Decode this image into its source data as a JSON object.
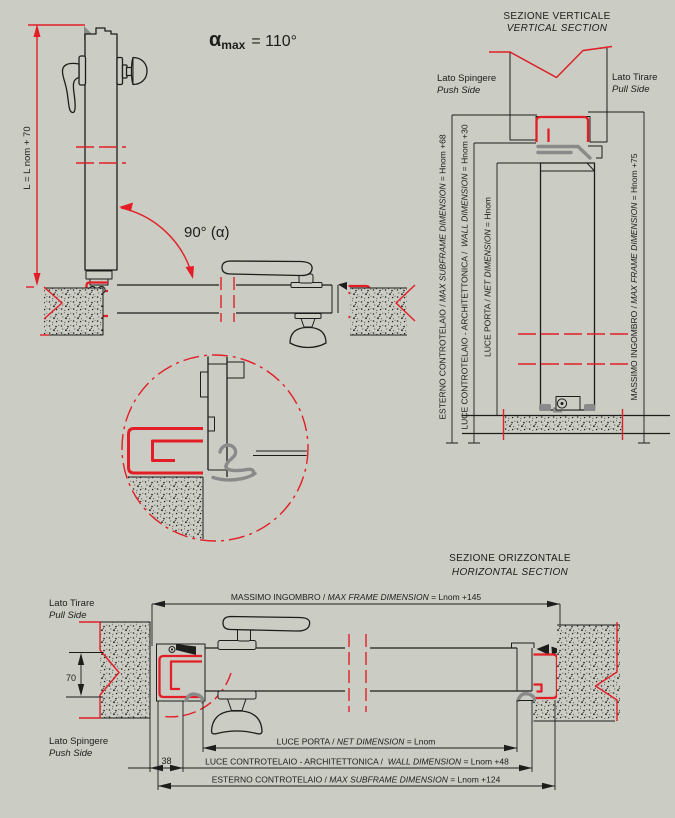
{
  "colors": {
    "background": "#cbccc4",
    "line": "#1d1d1b",
    "accent_red": "#e31e26",
    "gasket_gray": "#8a8a8a"
  },
  "top_view": {
    "alpha": {
      "symbol": "α",
      "sub": "max",
      "value": "= 110°"
    },
    "angle_open": "90° (α)",
    "height_dim": "L = L nom + 70"
  },
  "vertical_section": {
    "title": "SEZIONE VERTICALE",
    "subtitle": "VERTICAL SECTION",
    "push_side": {
      "it": "Lato Spingere",
      "en": "Push Side"
    },
    "pull_side": {
      "it": "Lato Tirare",
      "en": "Pull Side"
    },
    "dims": {
      "subframe_outer": {
        "it": "ESTERNO CONTROTELAIO / ",
        "en": "MAX SUBFRAME DIMENSION",
        "value": " = Hnom +68"
      },
      "wall_opening": {
        "it": "LUCE CONTROTELAIO - ARCHITETTONICA /  ",
        "en": "WALL DIMENSION",
        "value": " = Hnom +30"
      },
      "net_opening": {
        "it": "LUCE PORTA / ",
        "en": "NET DIMENSION",
        "value": " = Hnom"
      },
      "max_frame": {
        "it": "MASSIMO INGOMBRO / ",
        "en": "MAX FRAME DIMENSION",
        "value": " = Hnom +75"
      }
    }
  },
  "horizontal_section": {
    "title": "SEZIONE ORIZZONTALE",
    "subtitle": "HORIZONTAL SECTION",
    "pull_side": {
      "it": "Lato Tirare",
      "en": "Pull Side"
    },
    "push_side": {
      "it": "Lato Spingere",
      "en": "Push Side"
    },
    "wall_thickness": "70",
    "subframe_offset": "38",
    "dims": {
      "max_frame": {
        "it": "MASSIMO INGOMBRO / ",
        "en": "MAX FRAME DIMENSION",
        "value": " = Lnom +145"
      },
      "net_opening": {
        "it": "LUCE PORTA / ",
        "en": "NET DIMENSION",
        "value": " = Lnom"
      },
      "wall_opening": {
        "it": "LUCE CONTROTELAIO - ARCHITETTONICA /  ",
        "en": "WALL DIMENSION",
        "value": " = Lnom +48"
      },
      "subframe_outer": {
        "it": "ESTERNO CONTROTELAIO / ",
        "en": "MAX SUBFRAME DIMENSION",
        "value": " = Lnom +124"
      }
    }
  }
}
